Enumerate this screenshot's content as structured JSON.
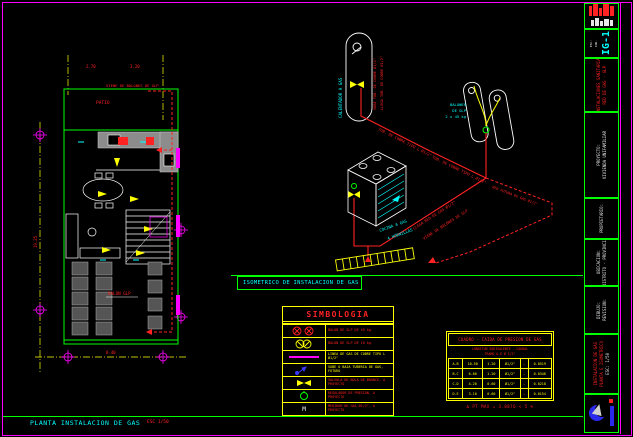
{
  "palette": {
    "background": "#000000",
    "border": "#ff00ff",
    "frame": "#00ff00",
    "annotation": "#ff2222",
    "symbol": "#ffff00",
    "label": "#00ffff"
  },
  "sheet": {
    "plan_title": "PLANTA INSTALACION DE GAS",
    "plan_scale": "ESC 1/50"
  },
  "plan": {
    "patio_label": "PATIO",
    "supply_note": "VIENE DE BALONES DE GLP",
    "balon_label": "BALON GLP",
    "dim_bottom": "8.40",
    "dim_left": "19.25",
    "dim_top_a": "2.70",
    "dim_top_b": "3.20"
  },
  "iso": {
    "title": "ISOMETRICO DE INSTALACION  DE GAS",
    "calentador_label": "CALENTADOR A GAS",
    "sube_label": "SUBE TUB. DE COBRE Ø1/2\"",
    "llega_label": "LLEGA TUB. DE COBRE Ø1/2\"",
    "pipe_label_1": "TUB. DE COBRE TIPO L Ø1/2\"",
    "balones_lines": [
      "BALONES",
      "DE GLP",
      "2 x 45 kg"
    ],
    "main_label_1": "LLEGA RED DE GAS Ø1/2\"",
    "main_label_2": "VIENE DE BALONES DE GLP",
    "future_label": "RED FUTURA DE GAS Ø1/2\"",
    "cocina_label_1": "COCINA A GAS",
    "cocina_label_2": "4 HORNILLAS"
  },
  "legend": {
    "title": "SIMBOLOGIA",
    "meter_glyph": "M",
    "items": [
      {
        "icon": "balon-45-icon",
        "label": "BALON DE GLP DE 45 kg."
      },
      {
        "icon": "balon-10-icon",
        "label": "BALON DE GLP DE 10 kg."
      },
      {
        "icon": "gas-line-icon",
        "label": "LINEA DE GAS DE COBRE TIPO L Ø1/2\""
      },
      {
        "icon": "riser-icon",
        "label": "SUBE O BAJA TUBERIA DE GAS, FUTURO"
      },
      {
        "icon": "valve-icon",
        "label": "VALVULA DE BOLA DE BRONCE, A PROYECTO"
      },
      {
        "icon": "regulator-icon",
        "label": "REGULADOR DE PRESION, A PROYECTO"
      },
      {
        "icon": "meter-icon",
        "label": "MEDIDOR DE GAS Ø1/2\", A PROYECTO"
      }
    ]
  },
  "gas_table": {
    "title": "CUADRO - CAIDA DE PRESION DE GAS",
    "subtitle1": "LONGITUD EQUIVALENTE - CAUDAL",
    "subtitle2": "TRAMO A-E   Ø 1/2\"",
    "rows": [
      [
        "A-B",
        "10.50",
        "1.20",
        "Ø1/2\"",
        "-",
        "0.0519"
      ],
      [
        "B-C",
        "6.80",
        "1.20",
        "Ø1/2\"",
        "-",
        "0.0346"
      ],
      [
        "C-D",
        "4.20",
        "0.60",
        "Ø1/2\"",
        "-",
        "0.0218"
      ],
      [
        "D-E",
        "3.10",
        "0.60",
        "Ø1/2\"",
        "-",
        "0.0154"
      ]
    ],
    "note": "Δ   PT MAX = 3.0876   < 5 %"
  },
  "titleblock": {
    "sheet_code": "IG-1",
    "c2_left": [
      "ESC:",
      "IND.",
      "FECHA:",
      "2020"
    ],
    "c3": [
      "INSTALACIONES SANITARIAS",
      "RED DE GAS - GLP"
    ],
    "c4": [
      "PROYECTO:",
      "VIVIENDA UNIFAMILIAR"
    ],
    "c5": [
      "PROPIETARIO:"
    ],
    "c6": [
      "UBICACION:",
      "DISTRITO - PROVINCIA"
    ],
    "c7": [
      "DIBUJO:",
      "REVISION:"
    ],
    "c8": [
      "INSTALACION DE GAS",
      "PLANTA E ISOMETRICO",
      "ESC: 1/50"
    ]
  }
}
